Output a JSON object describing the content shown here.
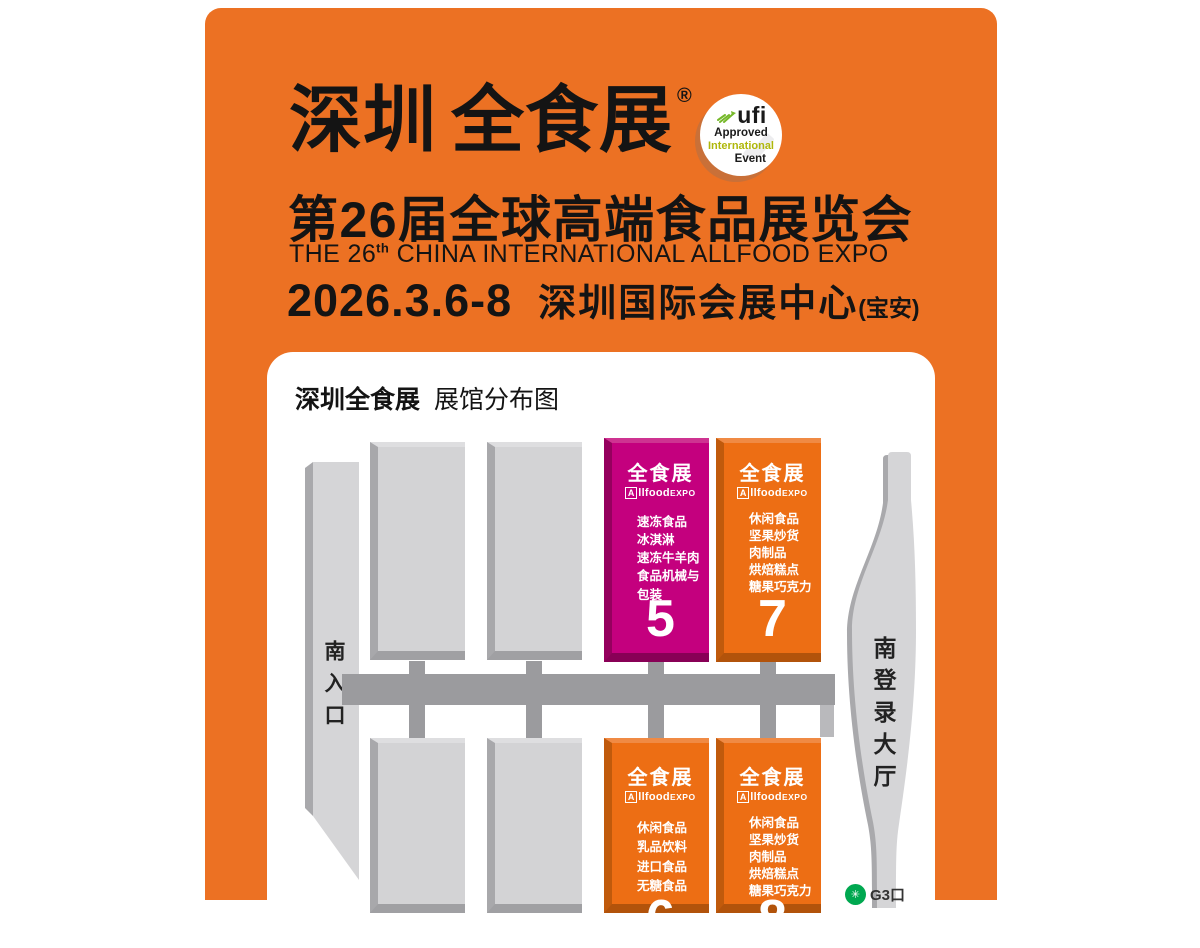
{
  "header": {
    "title_part1": "深圳",
    "title_part2": "全食展",
    "reg_mark": "®",
    "subtitle_cn": "第26届全球高端食品展览会",
    "subtitle_en_pre": "THE 26",
    "subtitle_en_sup": "th",
    "subtitle_en_post": " CHINA INTERNATIONAL ALLFOOD EXPO",
    "date": "2026.3.6-8",
    "venue": "深圳国际会展中心",
    "venue_suffix": "(宝安)"
  },
  "ufi": {
    "word": "ufi",
    "line_approved": "Approved",
    "line_international": "International",
    "line_event": "Event"
  },
  "card": {
    "title_bold": "深圳全食展",
    "title_normal": "展馆分布图",
    "south_entrance": "南入口",
    "south_login_hall": "南登录大厅",
    "metro_exit": "G3口",
    "brand": {
      "cn": "全食展",
      "en_a": "A",
      "en_mid": "llfood",
      "en_suffix": "EXPO"
    },
    "halls": {
      "hall5": {
        "number": "5",
        "items": [
          "速冻食品",
          "冰淇淋",
          "速冻牛羊肉",
          "食品机械与包装"
        ]
      },
      "hall7": {
        "number": "7",
        "items": [
          "休闲食品",
          "坚果炒货",
          "肉制品",
          "烘焙糕点",
          "糖果巧克力"
        ]
      },
      "hall6": {
        "number": "6",
        "items": [
          "休闲食品",
          "乳品饮料",
          "进口食品",
          "无糖食品"
        ]
      },
      "hall8": {
        "number": "8",
        "items": [
          "休闲食品",
          "坚果炒货",
          "肉制品",
          "烘焙糕点",
          "糖果巧克力"
        ]
      }
    }
  },
  "colors": {
    "background_orange": "#EC7123",
    "hall_orange": "#ED6E14",
    "hall_magenta": "#C4007E",
    "hall_gray": "#D3D3D5",
    "corridor_gray": "#9B9B9E",
    "ufi_green": "#AFB70A",
    "metro_green": "#00A850"
  }
}
